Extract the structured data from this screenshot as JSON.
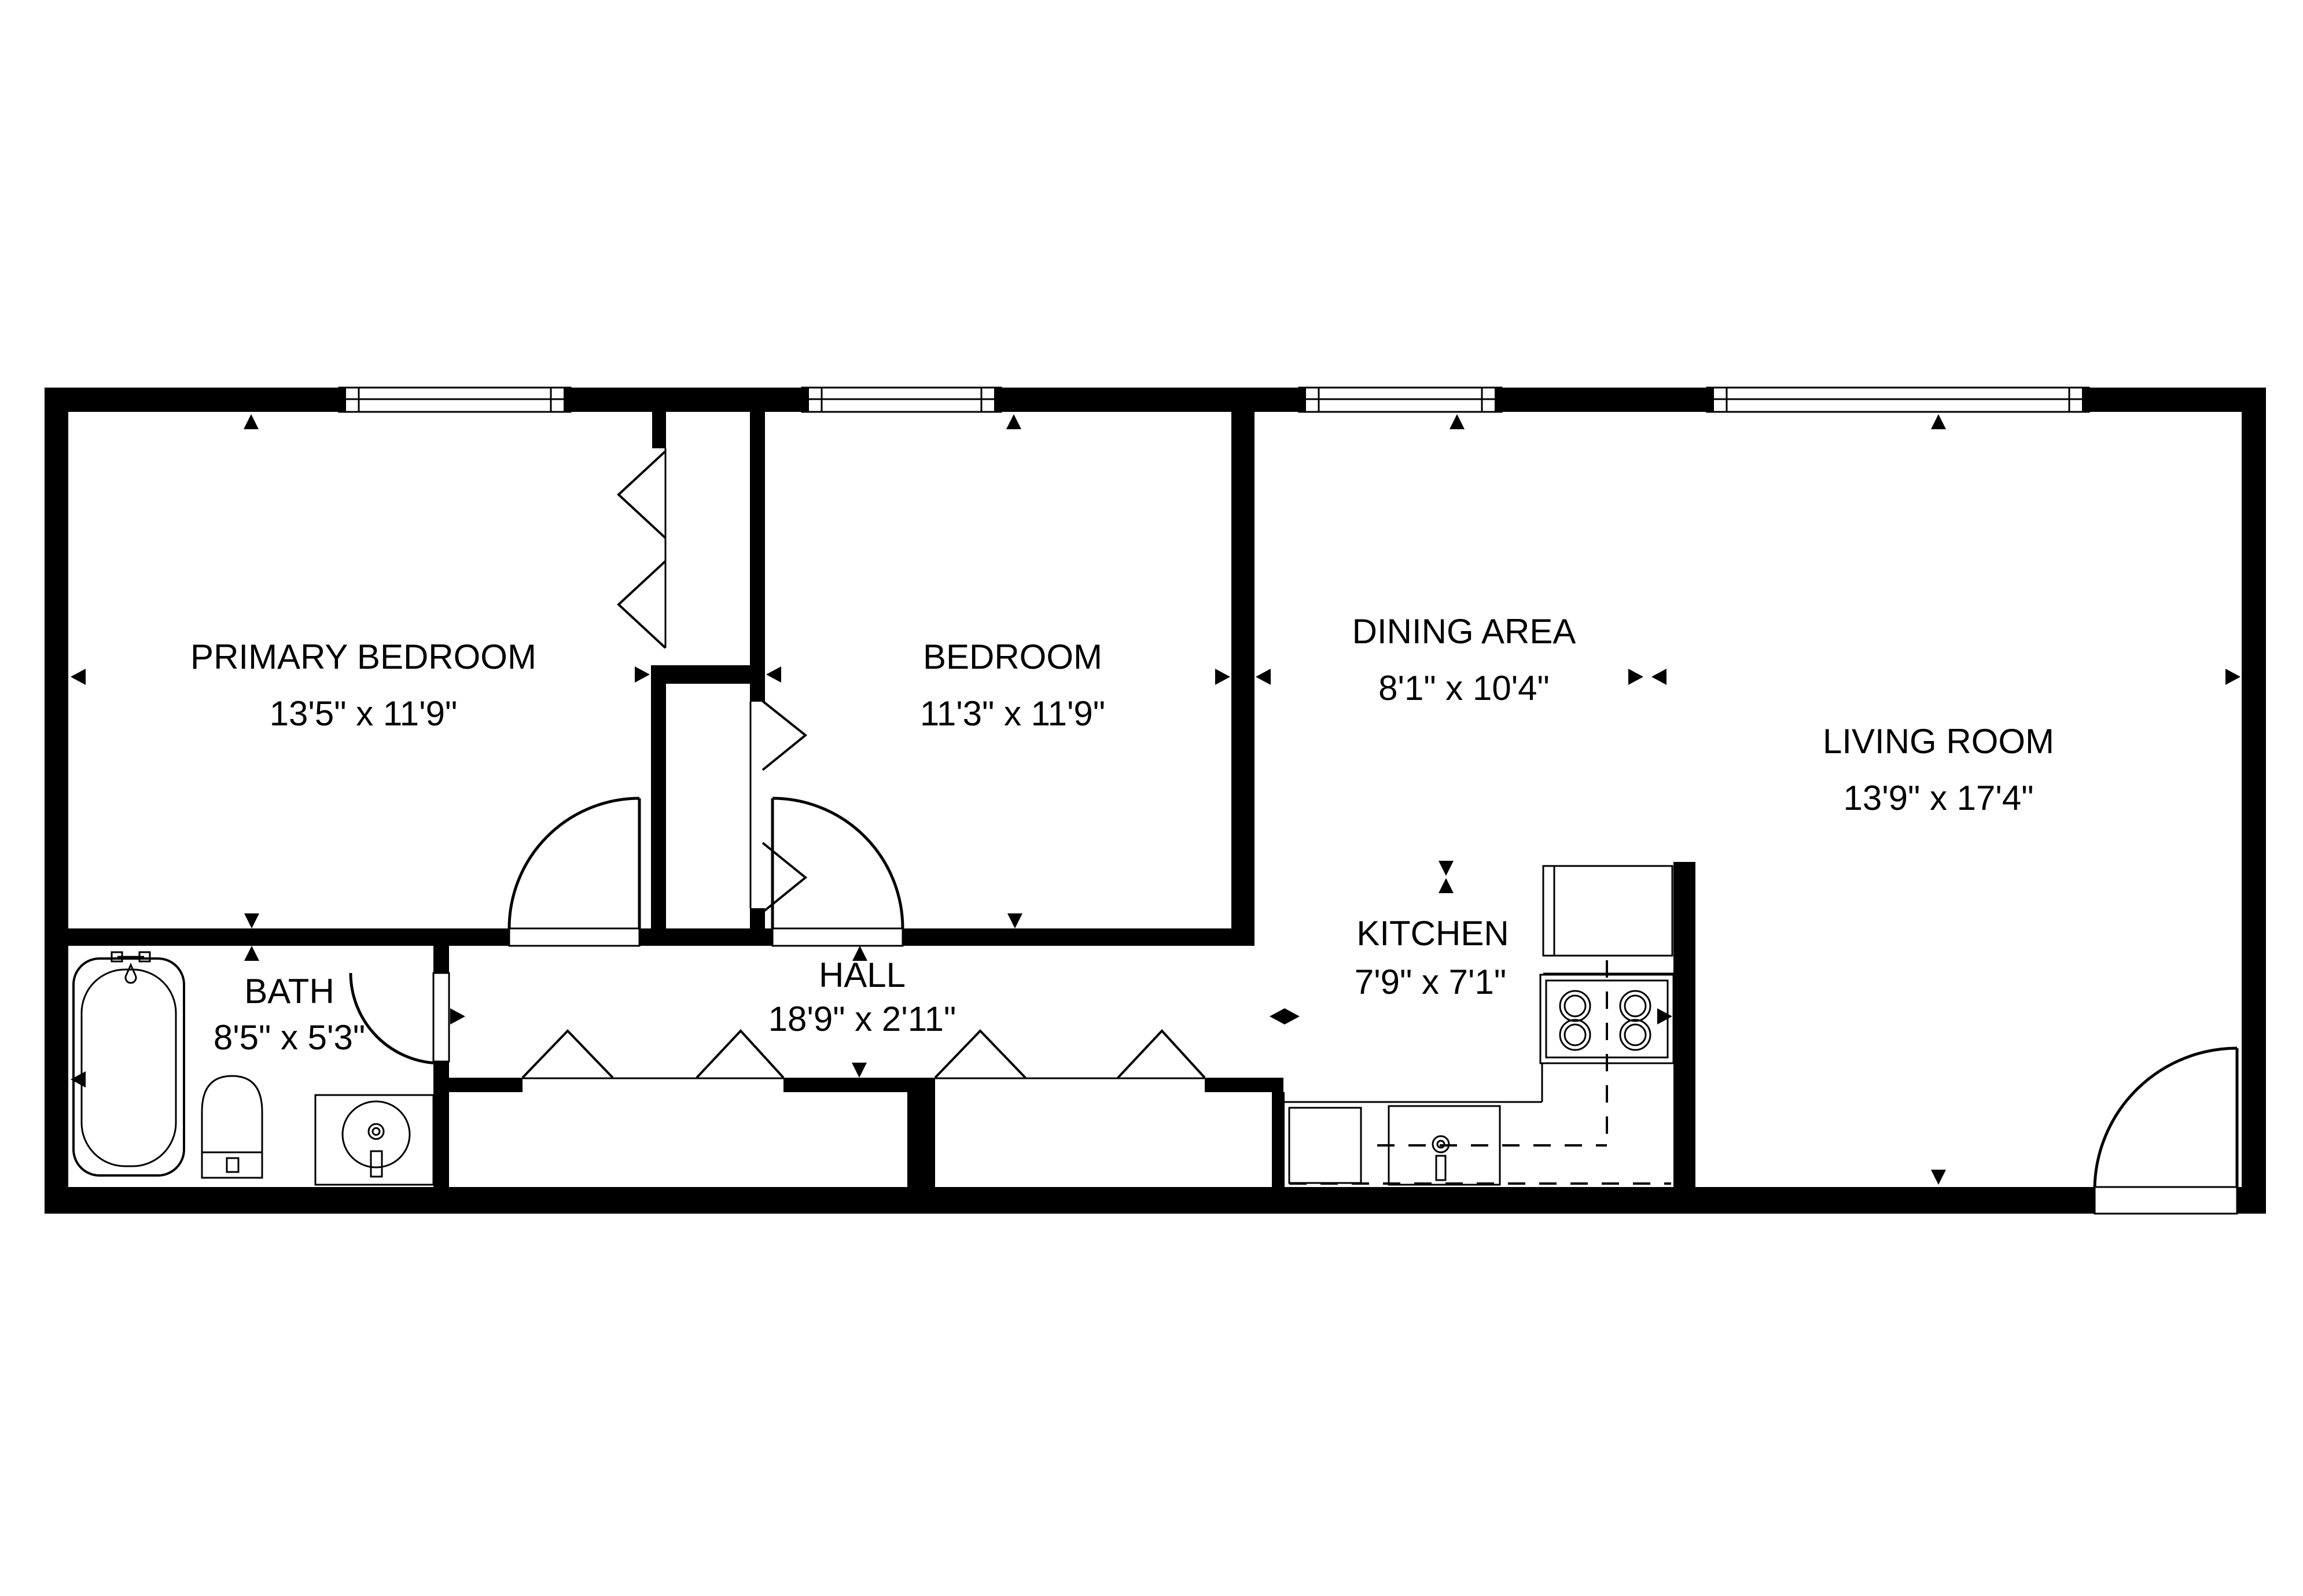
{
  "floorplan": {
    "title": "Apartment floor plan",
    "colors": {
      "wall": "#000000",
      "floor": "#ffffff",
      "line": "#000000"
    },
    "rooms": [
      {
        "id": "primary-bedroom",
        "name": "PRIMARY BEDROOM",
        "dims": "13'5\" x 11'9\""
      },
      {
        "id": "bedroom",
        "name": "BEDROOM",
        "dims": "11'3\" x 11'9\""
      },
      {
        "id": "dining-area",
        "name": "DINING AREA",
        "dims": "8'1\" x 10'4\""
      },
      {
        "id": "living-room",
        "name": "LIVING ROOM",
        "dims": "13'9\" x 17'4\""
      },
      {
        "id": "bath",
        "name": "BATH",
        "dims": "8'5\" x 5'3\""
      },
      {
        "id": "hall",
        "name": "HALL",
        "dims": "18'9\" x 2'11\""
      },
      {
        "id": "kitchen",
        "name": "KITCHEN",
        "dims": "7'9\" x 7'1\""
      }
    ],
    "fixtures": [
      "bathtub",
      "toilet",
      "vanity-sink",
      "refrigerator",
      "stove",
      "kitchen-sink",
      "dishwasher"
    ],
    "symbols": [
      "window",
      "hinged-door",
      "bifold-closet-door",
      "dimension-arrow"
    ]
  }
}
